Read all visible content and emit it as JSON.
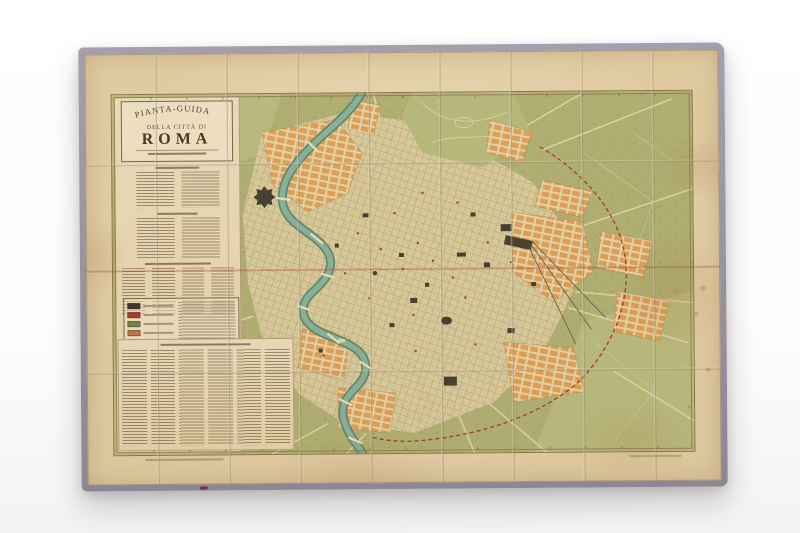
{
  "sheet": {
    "kind": "folded antique city map laid on white background",
    "title": {
      "arc": "PIANTA-GUIDA",
      "sub": "DELLA CITTÀ DI",
      "main": "ROMA"
    },
    "legend": {
      "swatches": [
        {
          "name": "swatch-black",
          "hex": "#3a342c"
        },
        {
          "name": "swatch-red",
          "hex": "#a83c30"
        },
        {
          "name": "swatch-green",
          "hex": "#6f8747"
        },
        {
          "name": "swatch-terracotta",
          "hex": "#c4764a"
        },
        {
          "name": "swatch-orange",
          "hex": "#d79a55"
        }
      ]
    },
    "colors": {
      "cloth_edge": "#9a93a1",
      "paper": "#ead9b4",
      "countryside_green": "#b2b274",
      "urban_buff": "#dcce9e",
      "district_orange": "#e2a158",
      "river_teal": "#7fae96",
      "monument_dark": "#453e30",
      "wall_red": "#a8392b",
      "frame_line": "#8a734f"
    }
  }
}
